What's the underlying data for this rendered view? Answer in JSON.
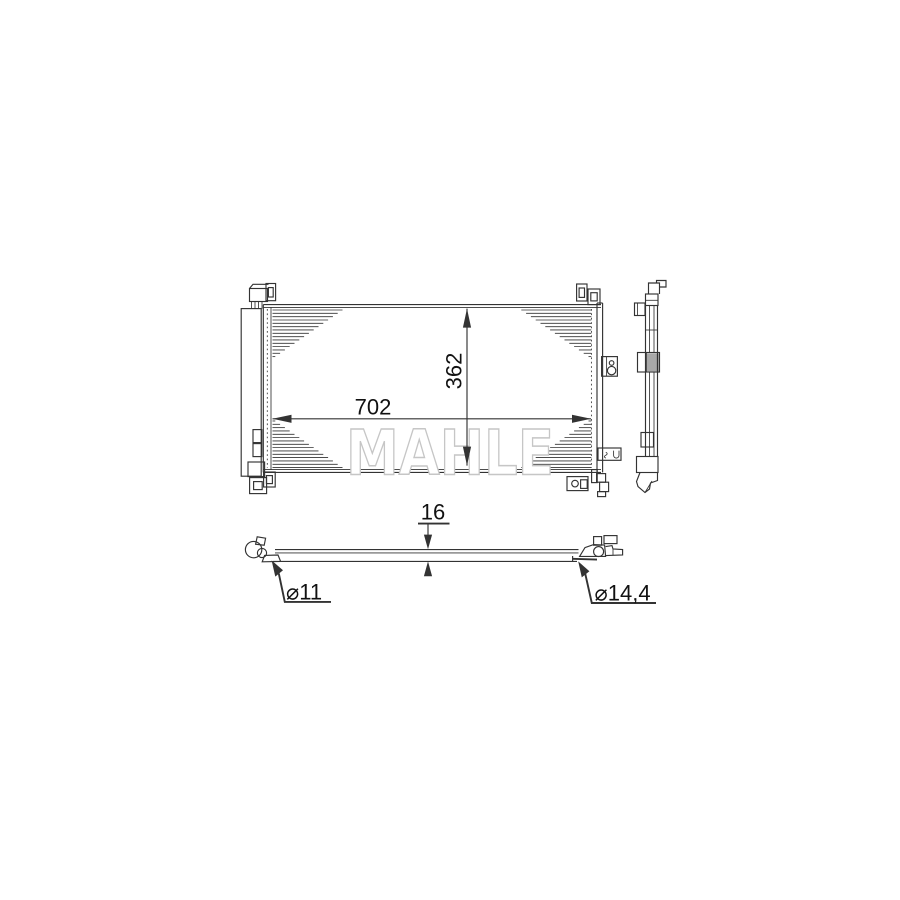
{
  "watermark": "MAHLE",
  "dimensions": {
    "core_width_mm": "702",
    "core_height_mm": "362",
    "depth_mm": "16",
    "port_diameter_left": "⌀11",
    "port_diameter_right": "⌀14,4"
  },
  "colors": {
    "line": "#333333",
    "dim_text": "#111111",
    "watermark_stroke": "#c6c6c6"
  }
}
